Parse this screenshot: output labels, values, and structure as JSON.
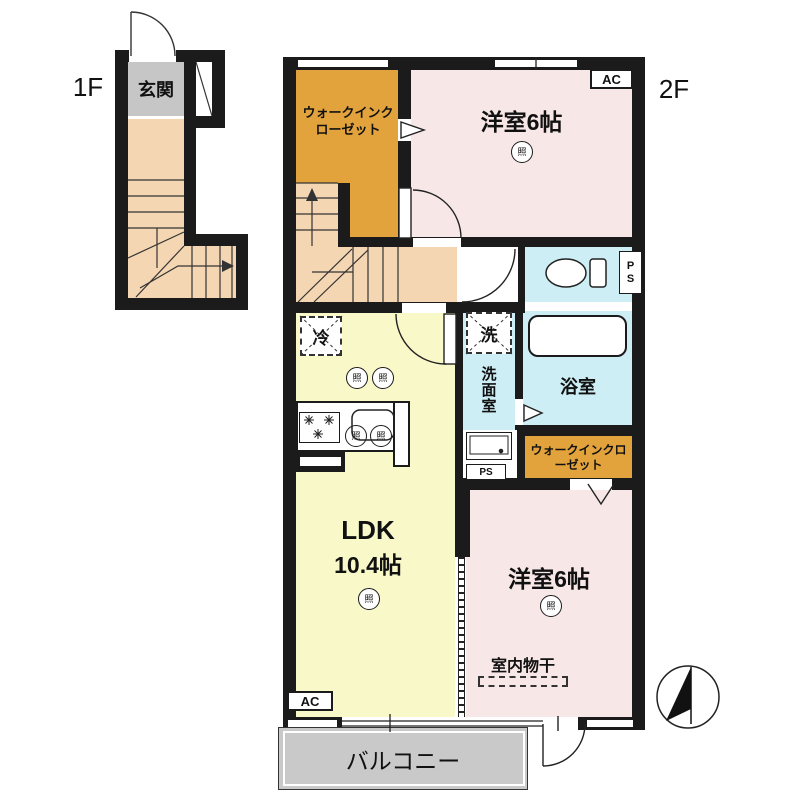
{
  "floor_1": {
    "label": "1F",
    "entrance": "玄関"
  },
  "floor_2": {
    "label": "2F",
    "walk_in_closet_top": "ウォークインクローゼット",
    "western_room_top": "洋室6帖",
    "western_room_bottom": "洋室6帖",
    "washroom": "洗面室",
    "laundry_machine": "洗",
    "bathroom": "浴室",
    "walk_in_closet_mid": "ウォークインクローゼット",
    "refrigerator": "冷",
    "ldk_label": "LDK",
    "ldk_size": "10.4帖",
    "indoor_drying": "室内物干",
    "balcony": "バルコニー",
    "ac_label": "AC",
    "pipe_space": "PS",
    "light_symbol": "照"
  },
  "colors": {
    "wall": "#1b1b1b",
    "closet_orange": "#e2a33c",
    "bedroom_pink": "#f8e7e7",
    "ldk_yellow": "#f9f8c9",
    "wet_area_blue": "#cdeef5",
    "stair_tan": "#f5d6b3",
    "entrance_gray": "#c6c6c6",
    "balcony_gray": "#c9c9c9"
  }
}
